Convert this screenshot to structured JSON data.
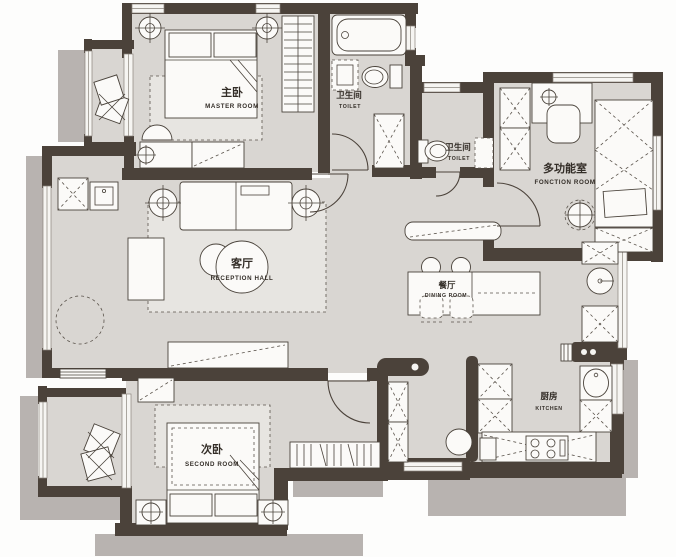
{
  "document": {
    "type": "apartment-floor-plan"
  },
  "colors": {
    "wall": "#4b423a",
    "floor": "#d9d6d2",
    "shadow": "#b8b3b0",
    "furniture": "#fbfaf8",
    "background": "#fdfdfc"
  },
  "rooms": [
    {
      "id": "master-bedroom",
      "label_zh": "主卧",
      "label_en": "MASTER ROOM"
    },
    {
      "id": "bathroom-top",
      "label_zh": "卫生间",
      "label_en": "TOILET"
    },
    {
      "id": "toilet-middle",
      "label_zh": "卫生间",
      "label_en": "TOILET"
    },
    {
      "id": "function-room",
      "label_zh": "多功能室",
      "label_en": "FONCTION ROOM"
    },
    {
      "id": "reception-hall",
      "label_zh": "客厅",
      "label_en": "RECEPTION HALL"
    },
    {
      "id": "dining-room",
      "label_zh": "餐厅",
      "label_en": "DINING ROOM"
    },
    {
      "id": "kitchen",
      "label_zh": "厨房",
      "label_en": "KITCHEN"
    },
    {
      "id": "second-bedroom",
      "label_zh": "次卧",
      "label_en": "SECOND ROOM"
    }
  ]
}
